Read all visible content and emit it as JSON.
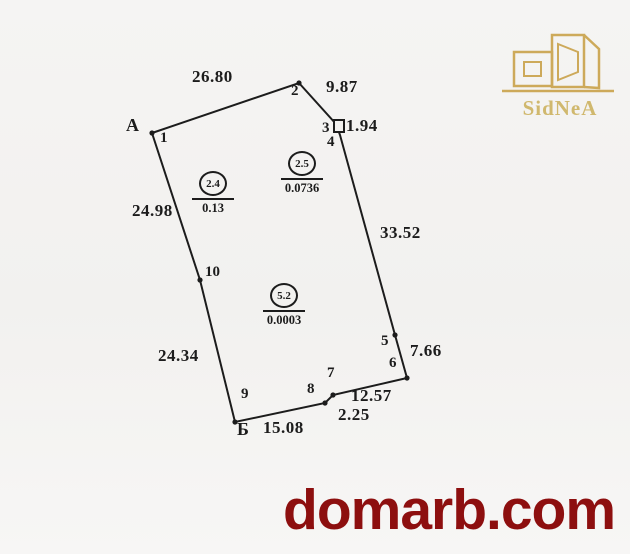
{
  "page": {
    "background": "#f2f1ef"
  },
  "logo": {
    "text": "SidNeA",
    "color": "#c9a24a"
  },
  "watermark": {
    "text": "domarb.com",
    "color": "#8d0f0f"
  },
  "plan": {
    "stroke": "#1c1c1c",
    "outline": [
      [
        152,
        133
      ],
      [
        299,
        83
      ],
      [
        336,
        124
      ],
      [
        340,
        135
      ],
      [
        395,
        335
      ],
      [
        407,
        378
      ],
      [
        333,
        395
      ],
      [
        325,
        403
      ],
      [
        235,
        422
      ],
      [
        200,
        280
      ]
    ],
    "dots": [
      [
        152,
        133
      ],
      [
        299,
        83
      ],
      [
        395,
        335
      ],
      [
        407,
        378
      ],
      [
        333,
        395
      ],
      [
        325,
        403
      ],
      [
        235,
        422
      ],
      [
        200,
        280
      ]
    ],
    "marker_square": {
      "x": 334,
      "y": 120,
      "w": 10,
      "h": 12
    },
    "labels": [
      {
        "text": "А",
        "x": 126,
        "y": 116,
        "cls": "letter",
        "name": "point-letter-a"
      },
      {
        "text": "Б",
        "x": 237,
        "y": 420,
        "cls": "letter",
        "name": "point-letter-b"
      },
      {
        "text": "1",
        "x": 160,
        "y": 131,
        "cls": "num",
        "name": "vertex-1"
      },
      {
        "text": "2",
        "x": 291,
        "y": 84,
        "cls": "num",
        "name": "vertex-2"
      },
      {
        "text": "3",
        "x": 322,
        "y": 121,
        "cls": "num",
        "name": "vertex-3"
      },
      {
        "text": "4",
        "x": 327,
        "y": 135,
        "cls": "num",
        "name": "vertex-4"
      },
      {
        "text": "5",
        "x": 381,
        "y": 334,
        "cls": "num",
        "name": "vertex-5"
      },
      {
        "text": "6",
        "x": 389,
        "y": 356,
        "cls": "num",
        "name": "vertex-6"
      },
      {
        "text": "7",
        "x": 327,
        "y": 366,
        "cls": "num",
        "name": "vertex-7"
      },
      {
        "text": "8",
        "x": 307,
        "y": 382,
        "cls": "num",
        "name": "vertex-8"
      },
      {
        "text": "9",
        "x": 241,
        "y": 387,
        "cls": "num",
        "name": "vertex-9"
      },
      {
        "text": "10",
        "x": 205,
        "y": 265,
        "cls": "num",
        "name": "vertex-10"
      },
      {
        "text": "26.80",
        "x": 192,
        "y": 68,
        "cls": "dist",
        "name": "distance-1-2"
      },
      {
        "text": "9.87",
        "x": 326,
        "y": 78,
        "cls": "dist",
        "name": "distance-2-3"
      },
      {
        "text": "1.94",
        "x": 346,
        "y": 117,
        "cls": "dist",
        "name": "distance-3-4"
      },
      {
        "text": "33.52",
        "x": 380,
        "y": 224,
        "cls": "dist",
        "name": "distance-4-5"
      },
      {
        "text": "7.66",
        "x": 410,
        "y": 342,
        "cls": "dist",
        "name": "distance-5-6"
      },
      {
        "text": "12.57",
        "x": 351,
        "y": 387,
        "cls": "dist",
        "name": "distance-6-7"
      },
      {
        "text": "2.25",
        "x": 338,
        "y": 406,
        "cls": "dist",
        "name": "distance-7-8"
      },
      {
        "text": "15.08",
        "x": 263,
        "y": 419,
        "cls": "dist",
        "name": "distance-8-9"
      },
      {
        "text": "24.34",
        "x": 158,
        "y": 347,
        "cls": "dist",
        "name": "distance-9-10"
      },
      {
        "text": "24.98",
        "x": 132,
        "y": 202,
        "cls": "dist",
        "name": "distance-10-1"
      }
    ],
    "sections": [
      {
        "number": "2.4",
        "area": "0.13",
        "cx": 213,
        "cy": 184
      },
      {
        "number": "2.5",
        "area": "0.0736",
        "cx": 302,
        "cy": 164
      },
      {
        "number": "5.2",
        "area": "0.0003",
        "cx": 284,
        "cy": 296
      }
    ]
  }
}
